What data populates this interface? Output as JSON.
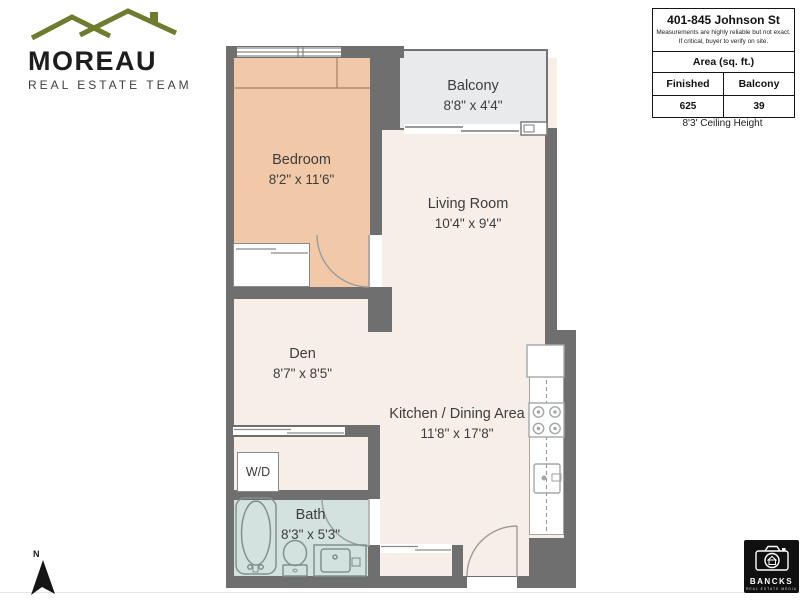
{
  "branding": {
    "moreau_name": "MOREAU",
    "moreau_subtitle": "REAL ESTATE TEAM",
    "bancks_name": "BANCKS",
    "bancks_subtitle": "REAL ESTATE MEDIA"
  },
  "info_box": {
    "address": "401-845 Johnson St",
    "disclaimer_line1": "Measurements are highly reliable but not exact.",
    "disclaimer_line2": "If critical, buyer to verify on site.",
    "area_header": "Area (sq. ft.)",
    "finished_label": "Finished",
    "finished_value": "625",
    "balcony_label": "Balcony",
    "balcony_value": "39",
    "ceiling_note": "8'3' Ceiling Height"
  },
  "rooms": {
    "bedroom": {
      "name": "Bedroom",
      "dims": "8'2\" x 11'6\""
    },
    "balcony": {
      "name": "Balcony",
      "dims": "8'8\" x 4'4\""
    },
    "living": {
      "name": "Living Room",
      "dims": "10'4\" x 9'4\""
    },
    "den": {
      "name": "Den",
      "dims": "8'7\" x 8'5\""
    },
    "kitchen": {
      "name": "Kitchen / Dining Area",
      "dims": "11'8\" x 17'8\""
    },
    "bath": {
      "name": "Bath",
      "dims": "8'3\" x 5'3\""
    },
    "wd": {
      "label": "W/D"
    }
  },
  "compass": {
    "north_label": "N"
  },
  "colors": {
    "wall": "#6f6f6f",
    "floor": "#f7eee8",
    "bedroom_fill": "#f1c9a8",
    "balcony_fill": "#e9eaeb",
    "bath_fill": "#d3e2df",
    "logo_green": "#6d7c2f",
    "fixture_stroke": "#8b9a97"
  }
}
